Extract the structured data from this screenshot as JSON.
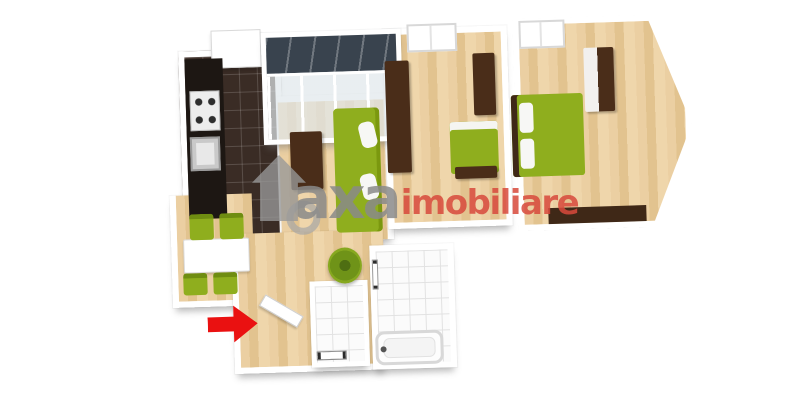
{
  "watermark": {
    "logo_icon": "house-icon",
    "text_primary": "axa",
    "text_secondary": "imobiliare",
    "color_primary": "#8a8a8a",
    "color_secondary": "#d84a3c"
  },
  "entrance_marker": {
    "icon": "arrow-right-icon",
    "color": "#ea1111",
    "direction": "right"
  },
  "palette": {
    "background": "#ffffff",
    "wall": "#ffffff",
    "wood_floor": "#e7c998",
    "kitchen_tile": "#3a2c25",
    "kitchen_counter": "#1d1713",
    "furniture_green": "#8fae1e",
    "furniture_brown": "#4a2d19",
    "bath_tile": "#fbfbfb",
    "glass_roof": "#39434e"
  },
  "rooms": [
    {
      "name": "kitchen",
      "floor": "dark-tile",
      "items": [
        "counter",
        "stove",
        "sink",
        "upper-cabinet"
      ]
    },
    {
      "name": "balcony",
      "floor": "glazed",
      "items": [
        "glass-roof",
        "glass-walls"
      ]
    },
    {
      "name": "living-room",
      "floor": "wood",
      "items": [
        "sofa",
        "tv-stand",
        "round-rug"
      ]
    },
    {
      "name": "dining-area",
      "floor": "wood",
      "items": [
        "table",
        "chair",
        "chair",
        "chair",
        "chair"
      ]
    },
    {
      "name": "bedroom-1",
      "floor": "wood",
      "items": [
        "window",
        "wardrobe",
        "cabinet",
        "daybed",
        "bench"
      ]
    },
    {
      "name": "bedroom-2",
      "floor": "wood",
      "items": [
        "window",
        "double-bed",
        "wardrobe",
        "shelf"
      ]
    },
    {
      "name": "hallway",
      "floor": "wood",
      "items": [
        "plant",
        "entry-door"
      ]
    },
    {
      "name": "wc",
      "floor": "white-tile",
      "items": [
        "radiator"
      ]
    },
    {
      "name": "bathroom",
      "floor": "white-tile",
      "items": [
        "bathtub",
        "towel-rail"
      ]
    }
  ]
}
